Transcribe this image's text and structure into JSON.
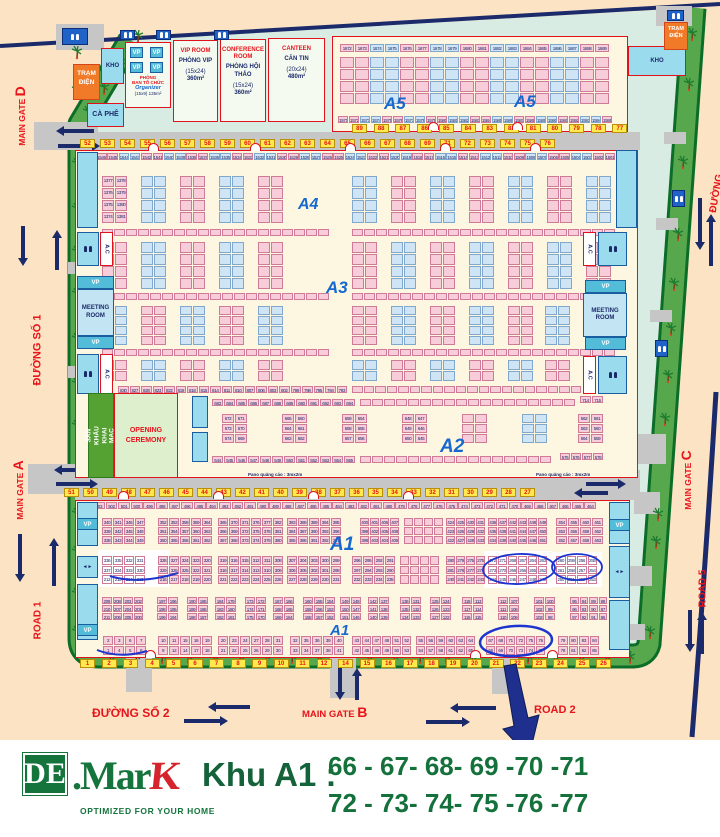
{
  "map": {
    "roads": {
      "main_gate": "MAIN GATE",
      "gate_a": "A",
      "gate_b": "B",
      "gate_c": "C",
      "gate_d": "D",
      "duong_so_1": "ĐƯỜNG SỐ 1",
      "duong_so_2": "ĐƯỜNG SỐ 2",
      "road_1": "ROAD 1",
      "road_2": "ROAD 2",
      "road_5": "ROAD 5",
      "duong_right": "ĐƯỜNG",
      "pano": "Pano quảng cáo : 3mx2m"
    },
    "buildings": {
      "tram_dien": "TRẠM ĐIỆN",
      "kho": "KHO",
      "ca_phe": "CÀ PHÊ",
      "vp": "VP",
      "ac": "A.C",
      "organizer": {
        "l1": "PHÒNG",
        "l2": "BAN TỔ CHỨC",
        "l3": "Organizer",
        "l4": "(15x9) 135m²"
      },
      "vip": {
        "en": "VIP ROOM",
        "vi": "PHÒNG VIP",
        "size": "(15x24)",
        "area": "360m²"
      },
      "conference": {
        "en": "CONFERENCE ROOM",
        "vi": "PHÒNG HỘI THẢO",
        "size": "(15x24)",
        "area": "360m²"
      },
      "canteen": {
        "en": "CANTEEN",
        "vi": "CĂN TIN",
        "size": "(20x24)",
        "area": "480m²"
      },
      "meeting_room": "MEETING ROOM",
      "san_khau": "SÂN KHẤU KHAI MẠC",
      "opening": "OPENING CEREMONY"
    },
    "zones": {
      "a1": "A1",
      "a2": "A2",
      "a3": "A3",
      "a4": "A4",
      "a5": "A5"
    },
    "gates": {
      "top": [
        "52",
        "53",
        "54",
        "55",
        "56",
        "57",
        "58",
        "59",
        "60",
        "61",
        "62",
        "63",
        "64",
        "65",
        "66",
        "67",
        "68",
        "69",
        "71",
        "72",
        "73",
        "74",
        "75",
        "76"
      ],
      "mid": [
        "51",
        "50",
        "49",
        "48",
        "47",
        "46",
        "45",
        "44",
        "43",
        "42",
        "41",
        "40",
        "39",
        "38",
        "37",
        "36",
        "35",
        "34",
        "33",
        "32",
        "31",
        "30",
        "29",
        "28",
        "27"
      ],
      "bottom": [
        "1",
        "2",
        "3",
        "4",
        "5",
        "6",
        "7",
        "8",
        "9",
        "10",
        "11",
        "12",
        "14",
        "15",
        "16",
        "17",
        "18",
        "19",
        "20",
        "21",
        "22",
        "23",
        "24",
        "25",
        "26"
      ],
      "a5": [
        "89",
        "88",
        "87",
        "86",
        "85",
        "84",
        "83",
        "82",
        "81",
        "80",
        "79",
        "78",
        "77"
      ]
    },
    "booths": {
      "a5_top": [
        "1672 1673 1674 1675 1676 1677 1678 1679 1680 1681 1682 1683 1684 1685 1686 1687 1688 1689"
      ],
      "a5_bottom": [
        "1571 1572 1573 1574 1575 1576 1577 1578 1579 1580 1581 1582 1583 1584 1585 1586 1587 1588 1589 1590 1591 1592 1593 1594 1595"
      ],
      "u1546": [
        "1546 1545 1544 1543 1542 1541 1540 1539 1538 1537 1536 1535 1534 1533 1532 1531 1530 1529 1528 1527 1526 1525 1524 1523 1522 1521 1520 1519 1518 1517 1516 1515 1514 1513 1512 1511 1510 1509 1508 1507 1506 1505 1504 1503 1502 1501"
      ],
      "u1377": [
        "1377 1378",
        "1376 1379",
        "1375 1380",
        "1374 1381"
      ],
      "u830": [
        "830 827 828 823 822 819 818 815 814 811 810 807 806 803 802 799 798 795 794 793"
      ],
      "u683": [
        "683 684 685 686 687 688 689 690 691 692 693 694"
      ],
      "u672": [
        "672 671",
        "673 670",
        "674 669"
      ],
      "u665": [
        "665 660",
        "664 661",
        "663 662"
      ],
      "u659": [
        "659 654",
        "658 655",
        "657 656"
      ],
      "u648": [
        "648 647",
        "649 646",
        "650 645"
      ],
      "u544": [
        "544 545 546 547 548 549 550 551 552 553 554 555"
      ],
      "u575": [
        "575 576 577 578"
      ],
      "u714": [
        "714 715"
      ],
      "u562": [
        "562 561",
        "563 560",
        "564 559"
      ],
      "l503": [
        "503 502 501 500 499 498 497 496 495 494 493 492 491 490 489 488 487 486 485 484 483 482 481 480 479 478 477 476 475 474 473 472 471 470 469 468 467 466 465 464"
      ],
      "b340": [
        "340 341 346 347",
        "339 342 345 348",
        "338 343 344 349"
      ],
      "b352": [
        "352 353 358 359 364",
        "351 354 357 360 363",
        "350 355 356 361 362"
      ],
      "b365": [
        "365 370 371 376 377 382",
        "366 369 372 375 378 381",
        "367 368 373 374 379 380"
      ],
      "b383": [
        "383 388 389 394 395",
        "384 387 390 393 396",
        "385 386 391 392 397"
      ],
      "b400": [
        "400 401 406 407",
        "399 402 405 408",
        "398 403 404 409"
      ],
      "b424": [
        "424 425 430 431",
        "423 426 429 432",
        "422 427 428 433"
      ],
      "b436": [
        "436 437 442 443 448 449",
        "435 438 441 444 447 450",
        "434 439 440 445 446 451"
      ],
      "b454": [
        "454 455 460 461",
        "453 456 459 462",
        "452 457 458 463"
      ],
      "b336": [
        "336 335 332 331",
        "337 334 333 330",
        "212 213 214 215"
      ],
      "b328": [
        "328 327 324 323 320",
        "329 326 325 322 321",
        "216 217 218 219 220"
      ],
      "b319": [
        "319 316 315 312 311 308",
        "318 317 314 313 310 309",
        "221 222 223 224 225 226"
      ],
      "b307": [
        "307 304 303 300 299",
        "306 305 302 301 298",
        "227 228 229 230 231"
      ],
      "b296": [
        "296 295 292 291",
        "297 294 293 290",
        "232 233 234 235"
      ],
      "b280": [
        "280 279 276 275",
        "281 278 277 274",
        "240 241 242 243"
      ],
      "b272": [
        "272 271 268 267 264 263",
        "273 270 269 266 265 262",
        "244 245 246 247 248 249"
      ],
      "b260": [
        "260 259 256 255",
        "261 258 257 254",
        "250 251 252 253"
      ],
      "b209": [
        "209 208 203 202",
        "210 207 204 201",
        "211 206 205 200"
      ],
      "b197": [
        "197 196",
        "198 195",
        "199 194"
      ],
      "b190": [
        "190 185",
        "189 186",
        "188 187"
      ],
      "b184": [
        "184 179",
        "183 180",
        "182 181"
      ],
      "b173": [
        "173 172",
        "174 171",
        "175 170"
      ],
      "b167": [
        "167 166",
        "168 165",
        "169 164"
      ],
      "b160": [
        "160 155 154",
        "159 156 153",
        "158 157 152"
      ],
      "b149": [
        "149 148",
        "150 147",
        "151 146"
      ],
      "b142": [
        "142 137",
        "141 138",
        "140 139"
      ],
      "b136": [
        "136 131",
        "135 132",
        "134 133"
      ],
      "b125": [
        "125 124",
        "126 123",
        "127 122"
      ],
      "b118": [
        "118 113",
        "117 114",
        "116 115"
      ],
      "b112": [
        "112 107",
        "111 108",
        "110 109"
      ],
      "b101": [
        "101 100",
        "102 99",
        "103 98"
      ],
      "b95": [
        "95 94 89 88",
        "96 93 90 87",
        "97 92 91 86"
      ],
      "c1": [
        "2 3 6 7",
        "1 4 5 8"
      ],
      "c2": [
        "10 11 15 16 19",
        "9 12 14 17 18"
      ],
      "c3": [
        "20 23 24 27 28 31",
        "21 22 25 26 29 30"
      ],
      "c4": [
        "32 35 36 39 40",
        "33 34 37 38 41"
      ],
      "c5": [
        "43 44 47 48 51 52",
        "42 45 46 49 50 53"
      ],
      "c6": [
        "55 56 59 60 63 64",
        "54 57 58 61 62 65"
      ],
      "c7": [
        "67 68 71 72 75 76",
        "66 69 70 73 74 77"
      ],
      "c8": [
        "79 80 83 84",
        "78 81 82 85"
      ]
    }
  },
  "banner": {
    "logo_de": "DE",
    "logo_mark": ".Mar",
    "logo_k": "K",
    "tagline": "OPTIMIZED FOR YOUR HOME",
    "khu": "Khu A1 :",
    "line1": "66 - 67- 68- 69 -70 -71",
    "line2": "72 - 73- 74- 75 -76 -77"
  }
}
